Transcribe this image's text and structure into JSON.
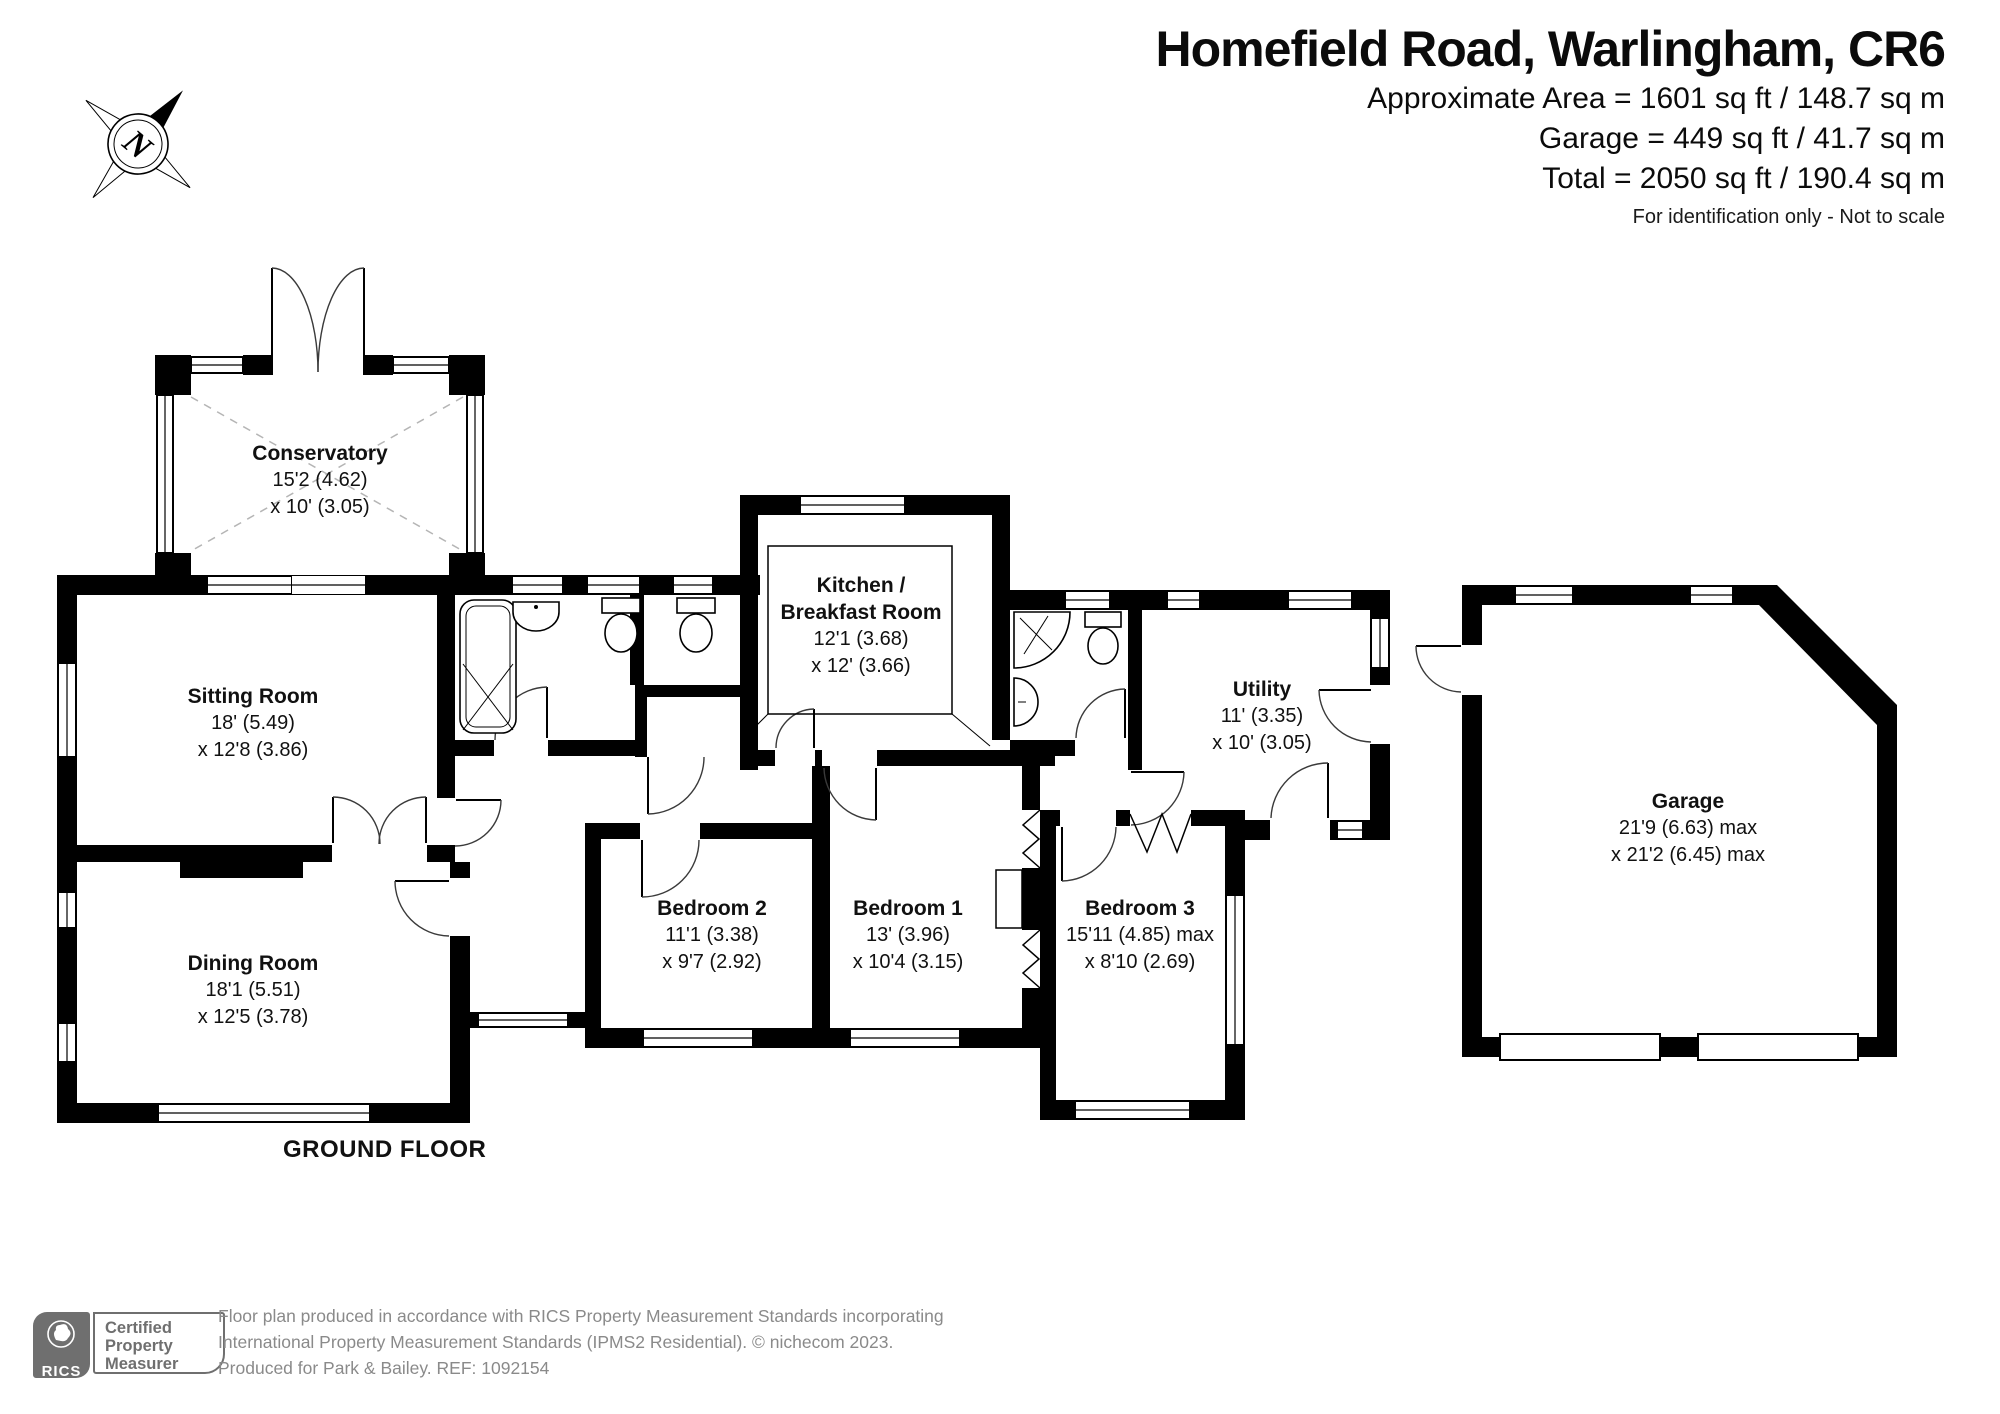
{
  "header": {
    "title": "Homefield Road, Warlingham, CR6",
    "area_lines": [
      "Approximate Area = 1601 sq ft / 148.7 sq m",
      "Garage = 449 sq ft / 41.7 sq m",
      "Total = 2050 sq ft / 190.4 sq m"
    ],
    "note": "For identification only - Not to scale"
  },
  "compass": {
    "label": "N"
  },
  "floor_label": "GROUND FLOOR",
  "rooms": {
    "conservatory": {
      "name": "Conservatory",
      "dims": [
        "15'2 (4.62)",
        "x 10' (3.05)"
      ]
    },
    "sitting_room": {
      "name": "Sitting Room",
      "dims": [
        "18' (5.49)",
        "x 12'8 (3.86)"
      ]
    },
    "dining_room": {
      "name": "Dining Room",
      "dims": [
        "18'1 (5.51)",
        "x 12'5 (3.78)"
      ]
    },
    "kitchen": {
      "name": "Kitchen /",
      "name2": "Breakfast Room",
      "dims": [
        "12'1 (3.68)",
        "x 12' (3.66)"
      ]
    },
    "utility": {
      "name": "Utility",
      "dims": [
        "11' (3.35)",
        "x 10' (3.05)"
      ]
    },
    "bedroom1": {
      "name": "Bedroom 1",
      "dims": [
        "13' (3.96)",
        "x 10'4 (3.15)"
      ]
    },
    "bedroom2": {
      "name": "Bedroom 2",
      "dims": [
        "11'1 (3.38)",
        "x 9'7 (2.92)"
      ]
    },
    "bedroom3": {
      "name": "Bedroom 3",
      "dims": [
        "15'11 (4.85) max",
        "x 8'10 (2.69)"
      ]
    },
    "garage": {
      "name": "Garage",
      "dims": [
        "21'9 (6.63) max",
        "x 21'2 (6.45) max"
      ]
    }
  },
  "footer": {
    "badge": {
      "brand": "RICS",
      "lines": [
        "Certified",
        "Property",
        "Measurer"
      ]
    },
    "disclaimer": [
      "Floor plan produced in accordance with RICS Property Measurement Standards incorporating",
      "International Property Measurement Standards (IPMS2 Residential).   © nichecom 2023.",
      "Produced for Park & Bailey.   REF: 1092154"
    ]
  },
  "colors": {
    "wall": "#000000",
    "badge_gray": "#6f6f6f",
    "footer_text": "#8a8a8a"
  }
}
